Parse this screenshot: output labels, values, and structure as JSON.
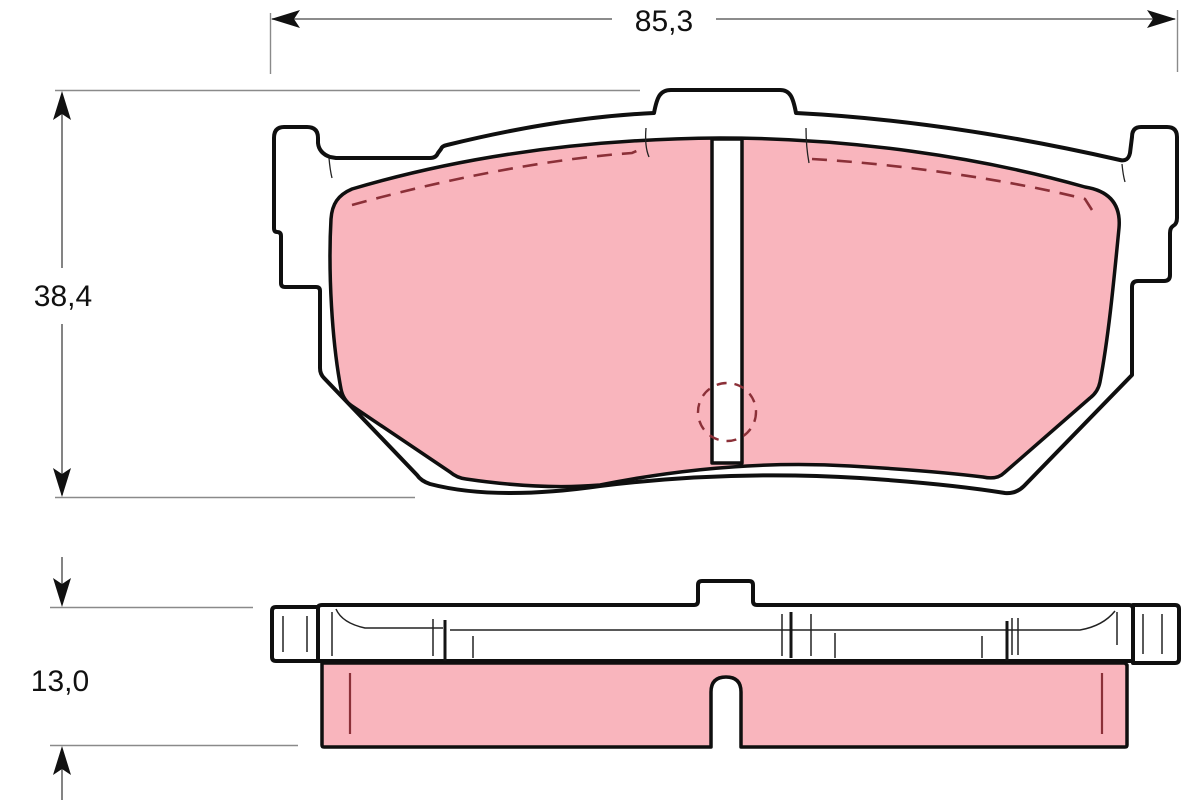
{
  "dimensions": {
    "width": "85,3",
    "height": "38,4",
    "thickness": "13,0"
  },
  "colors": {
    "friction": "#F9B5BD",
    "marking": "#8B3038",
    "outline": "#0f0f0f",
    "dim_line": "#666666",
    "ext_line": "#8a8a8a"
  }
}
